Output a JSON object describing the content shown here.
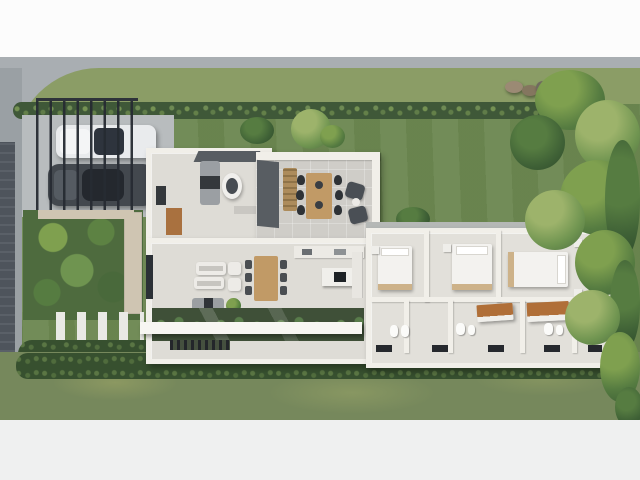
{
  "image_description": "Aerial top-down 3D render of a modern single-storey house floor plan with carport, gardens and lawn",
  "palette": {
    "margin_top": "#fcfcfc",
    "margin_bottom": "#eff0f0",
    "sidewalk": "#a9aeb2",
    "road_side": "#9aa0a4",
    "dark_paver": "#4e545c",
    "neighbor_lawn": "#8b9d66",
    "hedge": "#3f5838",
    "lawn": "#6d8852",
    "lawn_bottom": "#76885c",
    "shrub": "#37502f",
    "driveway": "#b8bcbe",
    "car_white": "#e9ebed",
    "car_glass": "#2e343d",
    "car_dark": "#43484e",
    "car_glass2": "#24282e",
    "garden_base": "#4e6b3e",
    "plant": "#4c7a3a",
    "plant_light": "#7fa04f",
    "gravel": "#cfc5b2",
    "slab": "#e9e9e5",
    "slab_bright": "#f7f6f2",
    "wall": "#f1efe9",
    "floor": "#dedcd6",
    "floor2": "#e2e0da",
    "terrace_floor": "#cfcdc8",
    "roof_dark": "#585d62",
    "wood": "#c19a66",
    "wood_bar": "#ad8c5c",
    "wood_door": "#a9713f",
    "wood_counter": "#b06f38",
    "chair_dark": "#2e3236",
    "dark_fabric": "#34383c",
    "sofa_white": "#edebe7",
    "bed": "#f3f2ef",
    "bed_base": "#cdb289",
    "glass_garden": "#3f5038"
  },
  "scene": {
    "site_elements": [
      "top sidewalk",
      "street edge left",
      "neighbor lawn strip",
      "trimmed hedge row",
      "main lawn with mow stripes",
      "rock cluster",
      "dense tree cluster right",
      "front garden with gravel path",
      "concrete stepping slats",
      "shrub border",
      "bottom lawn"
    ],
    "carport": {
      "structure": "slatted pergola roof",
      "surface": "concrete driveway",
      "vehicles": [
        "white sedan",
        "dark gray sedan"
      ]
    },
    "house": {
      "style": "white-walled cutaway dollhouse view",
      "rooms": [
        {
          "name": "entry foyer",
          "furniture": [
            "dark mat",
            "wood door panel"
          ]
        },
        {
          "name": "guest room",
          "furniture": [
            "gray daybed",
            "egg chair",
            "shelf"
          ]
        },
        {
          "name": "covered terrace",
          "furniture": [
            "wood slat bench",
            "outdoor dining table",
            "six black chairs",
            "two lounge chairs",
            "round side table"
          ]
        },
        {
          "name": "living room",
          "furniture": [
            "two white sofas",
            "two armchairs",
            "gray chaise with dark throw",
            "potted plant",
            "side window"
          ]
        },
        {
          "name": "dining area",
          "furniture": [
            "wood table",
            "six dark chairs"
          ]
        },
        {
          "name": "kitchen",
          "furniture": [
            "wall counter with appliances",
            "island with black cooktop",
            "tall cabinets"
          ]
        },
        {
          "name": "sunken garden skylight",
          "furniture": [
            "glass strip",
            "white canopy beam",
            "deck grate"
          ]
        },
        {
          "name": "bedroom 1",
          "furniture": [
            "double bed",
            "nightstands"
          ]
        },
        {
          "name": "bedroom 2",
          "furniture": [
            "double bed",
            "nightstands"
          ]
        },
        {
          "name": "master bedroom",
          "furniture": [
            "double bed",
            "nightstands"
          ]
        },
        {
          "name": "bathrooms",
          "furniture": [
            "toilets",
            "sinks",
            "dark shower mats"
          ]
        },
        {
          "name": "walk-in closet 1",
          "furniture": [
            "wood-top island"
          ]
        },
        {
          "name": "walk-in closet 2",
          "furniture": [
            "wood-top island"
          ]
        }
      ]
    }
  }
}
